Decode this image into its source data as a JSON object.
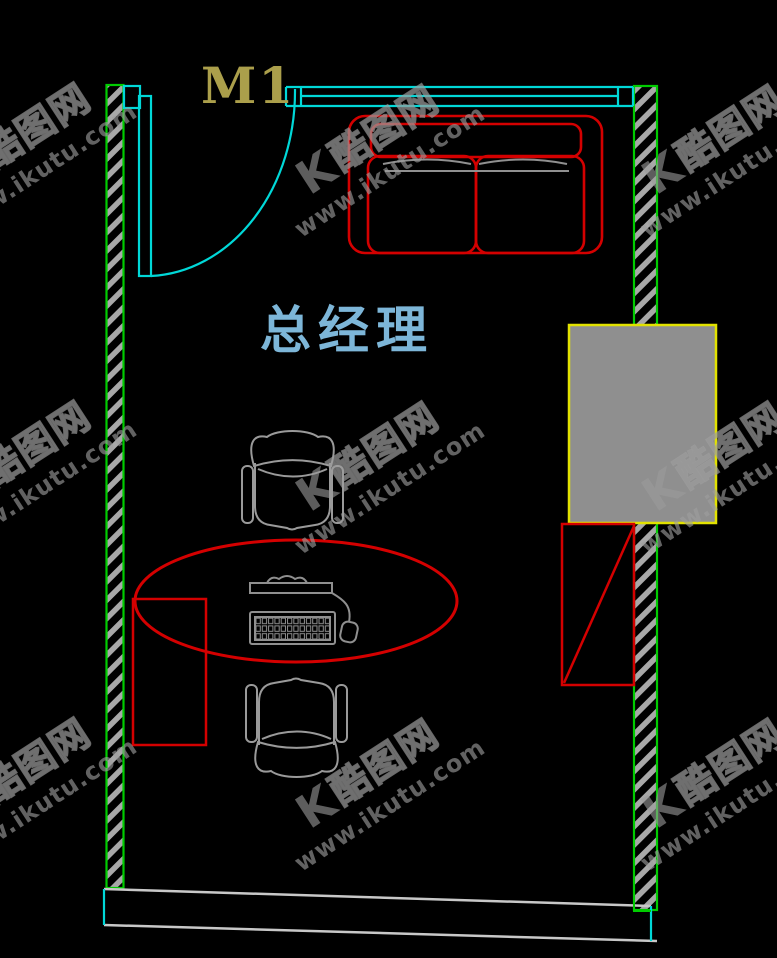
{
  "labels": {
    "door": "M1",
    "room": "总经理"
  },
  "watermark": {
    "logo": "K",
    "brand": "酷图网",
    "url": "www.ikutu.com"
  },
  "colors": {
    "background": "#000000",
    "wall_outline": "#00cc00",
    "wall_hatch": "#a8a8a8",
    "door_and_window": "#00d8d8",
    "furniture_red": "#d40000",
    "furniture_gray": "#9a9a9a",
    "bottom_wall_gray": "#c8c8c8",
    "cabinet_fill": "#8f8f8f",
    "cabinet_border": "#e2e200",
    "room_label_color": "#7db6d8",
    "door_label_color": "#ab9f4b",
    "watermark_gray": "#9b9b9b"
  }
}
